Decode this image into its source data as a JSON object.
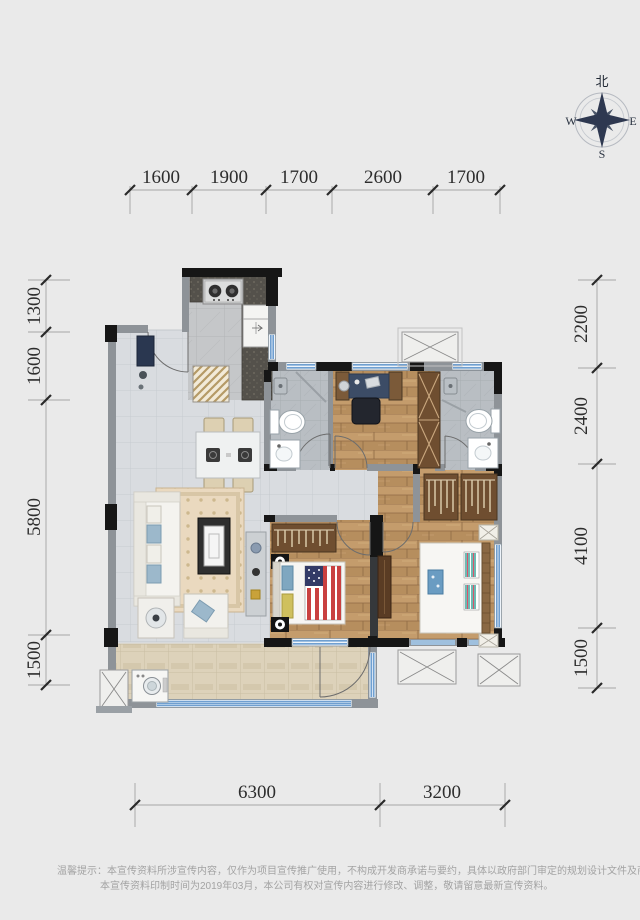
{
  "compass": {
    "north": "北",
    "west": "W",
    "east": "E",
    "south": "S"
  },
  "dimensions": {
    "top": [
      "1600",
      "1900",
      "1700",
      "2600",
      "1700"
    ],
    "left": [
      "1300",
      "1600",
      "5800",
      "1500"
    ],
    "right": [
      "2200",
      "2400",
      "4100",
      "1500"
    ],
    "bottom": [
      "6300",
      "3200"
    ]
  },
  "disclaimer": {
    "line1": "温馨提示：本宣传资料所涉宣传内容，仅作为项目宣传推广使用，不构成开发商承诺与要约，具体以政府部门审定的规划设计文件及商品房买卖合同约",
    "line2": "本宣传资料印制时间为2019年03月，本公司有权对宣传内容进行修改、调整，敬请留意最新宣传资料。"
  },
  "colors": {
    "background": "#eaeaea",
    "wall_black": "#161616",
    "wall_gray": "#8e9398",
    "window_blue": "#6f9fd0",
    "wood_floor": "#c49c6c",
    "dim_text": "#2d2d2d",
    "disclaimer_text": "#a3a3a3"
  }
}
